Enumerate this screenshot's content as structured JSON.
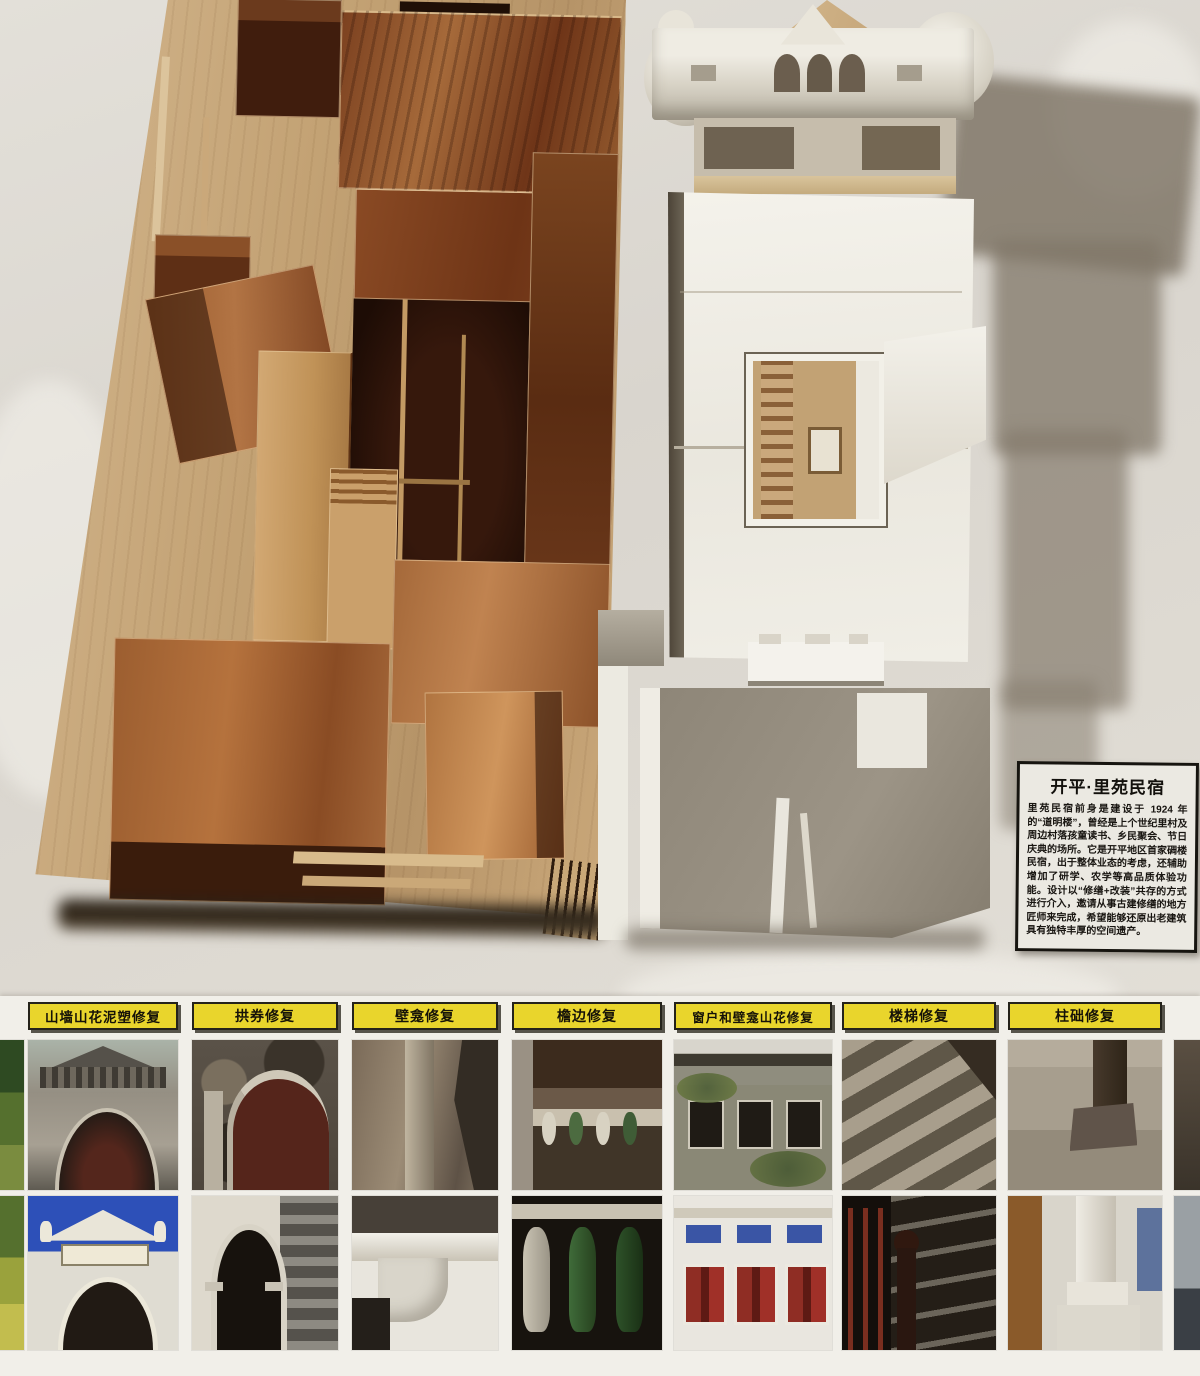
{
  "info_card": {
    "title": "开平·里苑民宿",
    "body": "里苑民宿前身是建设于 1924 年的“道明楼”，曾经是上个世纪里村及周边村落孩童读书、乡民聚会、节日庆典的场所。它是开平地区首家碉楼民宿，出于整体业态的考虑，还辅助增加了研学、农学等高品质体验功能。设计以“修缮+改装”共存的方式进行介入，邀请从事古建修缮的地方匠师来完成，希望能够还原出老建筑具有独特丰厚的空间遗产。"
  },
  "restoration_panel": {
    "categories": [
      {
        "label": "山墙山花泥塑修复"
      },
      {
        "label": "拱券修复"
      },
      {
        "label": "壁龛修复"
      },
      {
        "label": "檐边修复"
      },
      {
        "label": "窗户和壁龛山花修复"
      },
      {
        "label": "楼梯修复"
      },
      {
        "label": "柱础修复"
      }
    ]
  },
  "colors": {
    "label_yellow": "#e9d52c",
    "label_border": "#24221a",
    "wall": "#dcd8d1",
    "wood_dark": "#54290f",
    "wood_mid": "#7c441f",
    "wood_light": "#a86a38",
    "plywood_base": "#c7a87c",
    "model_white": "#f3f1ea",
    "wall_shadow": "#8d8577",
    "photo_sky_blue": "#2d50b8",
    "shutter_red": "#8f2d24",
    "panel_blue": "#3a55a5",
    "baluster_green": "#3f6b39"
  }
}
